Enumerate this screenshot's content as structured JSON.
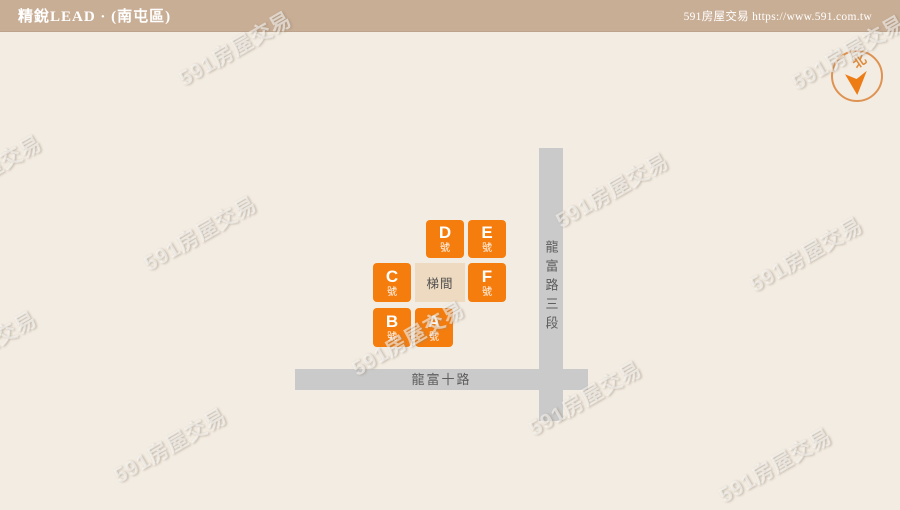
{
  "header": {
    "title": "精銳LEAD · (南屯區)",
    "site_label": "591房屋交易 https://www.591.com.tw"
  },
  "watermark": {
    "text": "591房屋交易"
  },
  "compass": {
    "north_label": "北"
  },
  "map": {
    "vertical_road": {
      "name": "龍富路三段"
    },
    "horizontal_road": {
      "name": "龍富十路"
    },
    "stairwell": {
      "label": "梯間"
    },
    "buildings": [
      {
        "id": "D",
        "letter": "D",
        "suffix": "號"
      },
      {
        "id": "E",
        "letter": "E",
        "suffix": "號"
      },
      {
        "id": "C",
        "letter": "C",
        "suffix": "號"
      },
      {
        "id": "F",
        "letter": "F",
        "suffix": "號"
      },
      {
        "id": "B",
        "letter": "B",
        "suffix": "號"
      },
      {
        "id": "A",
        "letter": "A",
        "suffix": "號"
      }
    ]
  },
  "colors": {
    "accent_orange": "#f57d0d",
    "header_tan": "#c9ae96",
    "background_beige": "#f3ece2",
    "road_gray": "#cacaca",
    "stairwell_tan": "#eedac0"
  }
}
